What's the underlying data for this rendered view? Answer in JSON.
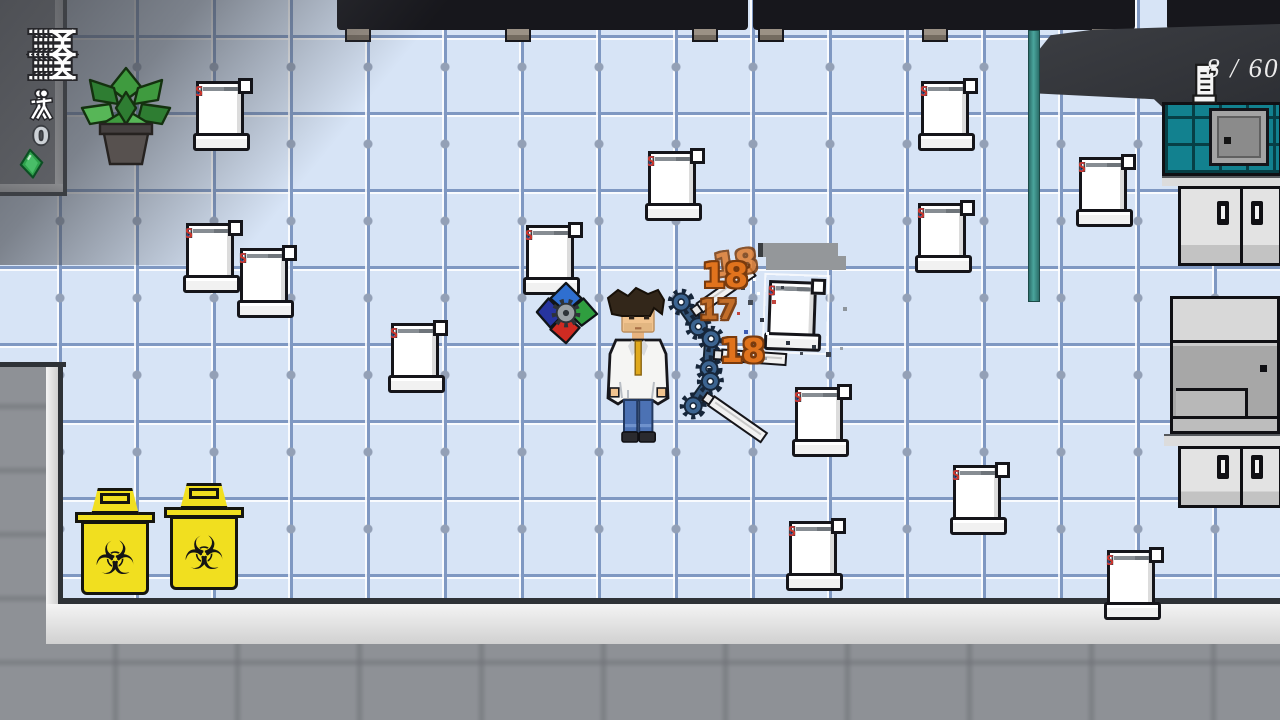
{
  "hud": {
    "dna_icon_count": 5,
    "researcher_icon_count": 2,
    "gem_count": "0",
    "scroll_counter": "8 / 60",
    "counter_text_color": "#ececec"
  },
  "enemies": {
    "label_letters": [
      {
        "char": "C",
        "color": "#2b57c8"
      },
      {
        "char": "N",
        "color": "#3a4047"
      },
      {
        "char": "S",
        "color": "#d2352b"
      }
    ],
    "line_widths": [
      33,
      26,
      35,
      21
    ],
    "line_colors": [
      "#6e747a",
      "#878d93",
      "#6e747a",
      "#878d93"
    ],
    "scrolls": [
      {
        "x": 193,
        "y": 76
      },
      {
        "x": 183,
        "y": 218
      },
      {
        "x": 237,
        "y": 243
      },
      {
        "x": 388,
        "y": 318
      },
      {
        "x": 523,
        "y": 220
      },
      {
        "x": 645,
        "y": 146
      },
      {
        "x": 918,
        "y": 76
      },
      {
        "x": 915,
        "y": 198
      },
      {
        "x": 1076,
        "y": 152
      },
      {
        "x": 765,
        "y": 276,
        "rot": 2,
        "hit": true
      },
      {
        "x": 792,
        "y": 382
      },
      {
        "x": 786,
        "y": 516
      },
      {
        "x": 950,
        "y": 460
      },
      {
        "x": 1104,
        "y": 545
      }
    ]
  },
  "combat": {
    "damage_color": "#e0731d",
    "damage_outline": "#7a3b0d",
    "damage_numbers": [
      {
        "text": "18",
        "x": 714,
        "y": 244,
        "size": 32,
        "color": "#dd7b2e",
        "rot": -8,
        "opacity": 0.85
      },
      {
        "text": "18",
        "x": 702,
        "y": 256,
        "size": 34,
        "color": "#e0731d",
        "rot": 0,
        "opacity": 1
      },
      {
        "text": "17",
        "x": 699,
        "y": 293,
        "size": 28,
        "color": "#c2681f",
        "rot": 0,
        "opacity": 0.95
      },
      {
        "text": "18",
        "x": 720,
        "y": 331,
        "size": 33,
        "color": "#e0731d",
        "rot": 0,
        "opacity": 1
      }
    ],
    "projectiles": [
      {
        "x": 666,
        "y": 268,
        "rot": -35
      },
      {
        "x": 692,
        "y": 328,
        "rot": 4
      },
      {
        "x": 678,
        "y": 384,
        "rot": 35
      }
    ],
    "health_bar": {
      "x": 758,
      "y": 243,
      "w": 80,
      "h": 14
    },
    "particles": [
      {
        "x": 741,
        "y": 286,
        "s": 4,
        "c": "#3b4049"
      },
      {
        "x": 753,
        "y": 278,
        "s": 3,
        "c": "#ffffff"
      },
      {
        "x": 748,
        "y": 300,
        "s": 5,
        "c": "#454b55"
      },
      {
        "x": 737,
        "y": 312,
        "s": 3,
        "c": "#c2453d"
      },
      {
        "x": 760,
        "y": 318,
        "s": 4,
        "c": "#2e3440"
      },
      {
        "x": 744,
        "y": 330,
        "s": 4,
        "c": "#3c5ab2"
      },
      {
        "x": 756,
        "y": 343,
        "s": 3,
        "c": "#454b55"
      },
      {
        "x": 736,
        "y": 353,
        "s": 4,
        "c": "#30363f"
      },
      {
        "x": 764,
        "y": 357,
        "s": 3,
        "c": "#9aa1a8"
      },
      {
        "x": 772,
        "y": 300,
        "s": 4,
        "c": "#c2453d"
      },
      {
        "x": 781,
        "y": 286,
        "s": 3,
        "c": "#3b4049"
      },
      {
        "x": 786,
        "y": 341,
        "s": 4,
        "c": "#2e3440"
      },
      {
        "x": 800,
        "y": 352,
        "s": 3,
        "c": "#454b55"
      },
      {
        "x": 812,
        "y": 345,
        "s": 4,
        "c": "#30363f"
      },
      {
        "x": 826,
        "y": 352,
        "s": 5,
        "c": "#3b4049"
      },
      {
        "x": 840,
        "y": 347,
        "s": 3,
        "c": "#9aa1a8"
      },
      {
        "x": 748,
        "y": 264,
        "s": 3,
        "c": "#454b55"
      },
      {
        "x": 843,
        "y": 307,
        "s": 4,
        "c": "#8e959c"
      },
      {
        "x": 757,
        "y": 292,
        "s": 3,
        "c": "#ffffff"
      },
      {
        "x": 766,
        "y": 332,
        "s": 3,
        "c": "#ffffff"
      }
    ]
  },
  "scenery": {
    "benches": [
      {
        "x": 337,
        "w": 411,
        "panels": 4,
        "legs": [
          345,
          505,
          692
        ]
      },
      {
        "x": 753,
        "w": 382,
        "panels": 4,
        "legs": [
          758,
          922,
          1090
        ]
      },
      {
        "x": 1167,
        "w": 113,
        "panels": 1,
        "legs": []
      }
    ],
    "bins": [
      {
        "x": 74,
        "y": 484
      },
      {
        "x": 163,
        "y": 479
      }
    ],
    "biohazard_symbol": "☣",
    "bin_color": "#f1df1f",
    "teal_color": "#12818f"
  }
}
